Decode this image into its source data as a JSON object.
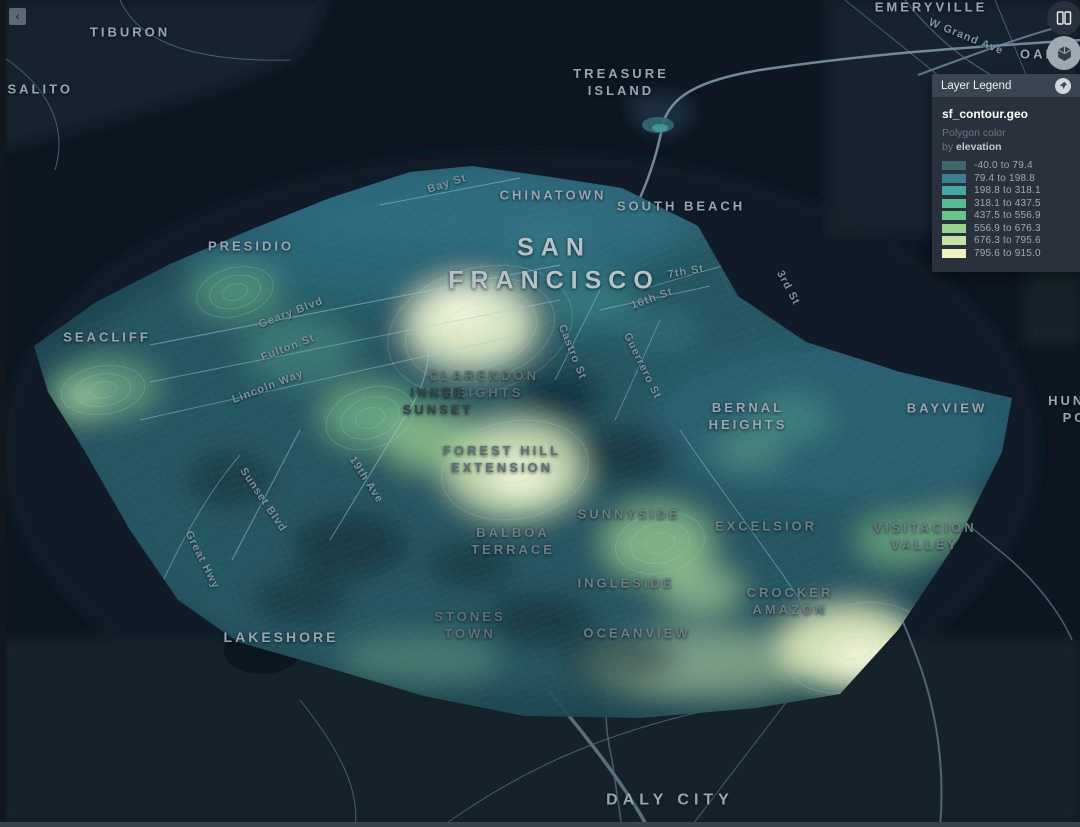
{
  "colors": {
    "map_bg": "#0d1721",
    "panel_bg": "#29323c",
    "panel_header": "#3a4552",
    "label": "#97a6b1"
  },
  "controls": {
    "collapse": {
      "icon": "chevron-left-icon",
      "glyph": "‹"
    },
    "split_map": {
      "icon": "split-map-icon"
    },
    "view_3d": {
      "icon": "cube-3d-icon"
    },
    "legend_pin": {
      "icon": "pin-icon"
    }
  },
  "legend": {
    "title": "Layer Legend",
    "layer_name": "sf_contour.geo",
    "channel": "Polygon color",
    "by_prefix": "by ",
    "field": "elevation",
    "items": [
      {
        "swatch": "#40666d",
        "label": "-40.0 to 79.4"
      },
      {
        "swatch": "#3f7f93",
        "label": "79.4 to 198.8"
      },
      {
        "swatch": "#4aa6a2",
        "label": "198.8 to 318.1"
      },
      {
        "swatch": "#57b98e",
        "label": "318.1 to 437.5"
      },
      {
        "swatch": "#6cc588",
        "label": "437.5 to 556.9"
      },
      {
        "swatch": "#96d48c",
        "label": "556.9 to 676.3"
      },
      {
        "swatch": "#c4e3a6",
        "label": "676.3 to 795.6"
      },
      {
        "swatch": "#edf2c0",
        "label": "795.6 to 915.0"
      }
    ]
  },
  "map": {
    "city_labels": [
      {
        "lines": [
          "TIBURON"
        ],
        "x": 130,
        "y": 33
      },
      {
        "lines": [
          "SAUSALITO"
        ],
        "x": 22,
        "y": 90
      },
      {
        "lines": [
          "EMERYVILLE"
        ],
        "x": 931,
        "y": 8
      },
      {
        "lines": [
          "OAKLAND"
        ],
        "x": 1063,
        "y": 55
      },
      {
        "lines": [
          "TREASURE",
          "ISLAND"
        ],
        "x": 621,
        "y": 83
      },
      {
        "lines": [
          "CHINATOWN"
        ],
        "x": 553,
        "y": 196
      },
      {
        "lines": [
          "SOUTH BEACH"
        ],
        "x": 681,
        "y": 207
      },
      {
        "lines": [
          "SAN",
          "FRANCISCO"
        ],
        "x": 554,
        "y": 264,
        "size": 25,
        "spacing": 7,
        "color": "#b6c2ca"
      },
      {
        "lines": [
          "PRESIDIO"
        ],
        "x": 251,
        "y": 247
      },
      {
        "lines": [
          "SEACLIFF"
        ],
        "x": 107,
        "y": 338
      },
      {
        "lines": [
          "CLARENDON",
          "HEIGHTS"
        ],
        "x": 484,
        "y": 385,
        "color": "#5e7077"
      },
      {
        "lines": [
          "INNER",
          "SUNSET"
        ],
        "x": 438,
        "y": 402,
        "color": "#33454c"
      },
      {
        "lines": [
          "FOREST HILL",
          "EXTENSION"
        ],
        "x": 502,
        "y": 460,
        "color": "#5e7077"
      },
      {
        "lines": [
          "BERNAL",
          "HEIGHTS"
        ],
        "x": 748,
        "y": 417
      },
      {
        "lines": [
          "BAYVIEW"
        ],
        "x": 947,
        "y": 409
      },
      {
        "lines": [
          "HUNTERS",
          "POINT"
        ],
        "x": 1090,
        "y": 410
      },
      {
        "lines": [
          "BALBOA",
          "TERRACE"
        ],
        "x": 513,
        "y": 542,
        "color": "#6b7d85"
      },
      {
        "lines": [
          "SUNNYSIDE"
        ],
        "x": 629,
        "y": 515,
        "color": "#6b7d85"
      },
      {
        "lines": [
          "EXCELSIOR"
        ],
        "x": 766,
        "y": 527,
        "color": "#6b7d85"
      },
      {
        "lines": [
          "VISITACION",
          "VALLEY"
        ],
        "x": 925,
        "y": 537,
        "color": "#6b7d85"
      },
      {
        "lines": [
          "INGLESIDE"
        ],
        "x": 626,
        "y": 584,
        "color": "#6b7d85"
      },
      {
        "lines": [
          "CROCKER",
          "AMAZON"
        ],
        "x": 790,
        "y": 602,
        "color": "#6b7d85"
      },
      {
        "lines": [
          "OCEANVIEW"
        ],
        "x": 637,
        "y": 634,
        "color": "#6b7d85"
      },
      {
        "lines": [
          "STONES",
          "TOWN"
        ],
        "x": 470,
        "y": 626,
        "color": "#5e7077"
      },
      {
        "lines": [
          "LAKESHORE"
        ],
        "x": 281,
        "y": 637,
        "size": 14
      },
      {
        "lines": [
          "DALY CITY"
        ],
        "x": 670,
        "y": 801,
        "size": 16,
        "spacing": 5
      }
    ],
    "street_labels": [
      {
        "text": "W Grand Ave",
        "x": 966,
        "y": 37,
        "rotate": 22
      },
      {
        "text": "Bay St",
        "x": 447,
        "y": 184,
        "rotate": -18
      },
      {
        "text": "7th St",
        "x": 686,
        "y": 272,
        "rotate": -10
      },
      {
        "text": "3rd St",
        "x": 788,
        "y": 288,
        "rotate": 62
      },
      {
        "text": "16th St",
        "x": 652,
        "y": 299,
        "rotate": -20
      },
      {
        "text": "Geary Blvd",
        "x": 291,
        "y": 313,
        "rotate": -21
      },
      {
        "text": "Fulton St",
        "x": 288,
        "y": 348,
        "rotate": -21
      },
      {
        "text": "Castro St",
        "x": 572,
        "y": 352,
        "rotate": 68
      },
      {
        "text": "Guerrero St",
        "x": 642,
        "y": 366,
        "rotate": 64
      },
      {
        "text": "Lincoln Way",
        "x": 268,
        "y": 387,
        "rotate": -21
      },
      {
        "text": "19th Ave",
        "x": 366,
        "y": 480,
        "rotate": 57
      },
      {
        "text": "Sunset Blvd",
        "x": 263,
        "y": 500,
        "rotate": 56
      },
      {
        "text": "Great Hwy",
        "x": 202,
        "y": 560,
        "rotate": 63
      }
    ]
  }
}
